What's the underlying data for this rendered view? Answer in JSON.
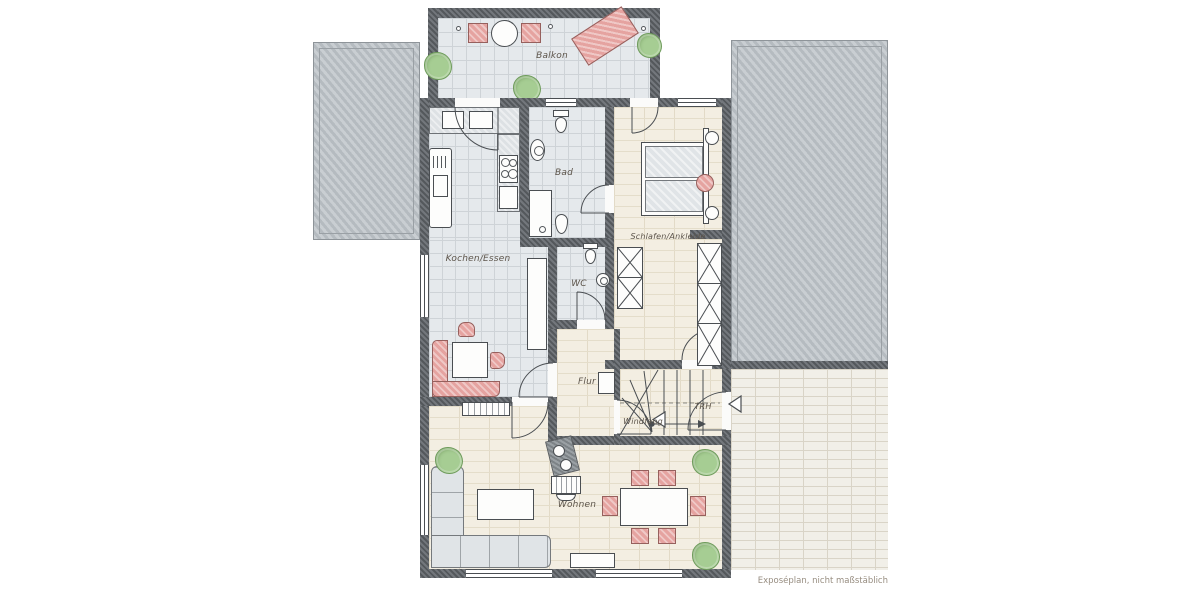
{
  "plan_type": "floor-plan",
  "footer_note": "Exposéplan, nicht maßstäblich",
  "rooms": {
    "balkon": "Balkon",
    "bad": "Bad",
    "kochen_essen": "Kochen/Essen",
    "schlafen_ankleide": "Schlafen/Ankleide",
    "wc": "WC",
    "flur": "Flur",
    "windfang": "Windfang",
    "trh": "TRH",
    "wohnen": "Wohnen"
  },
  "colors": {
    "wall": "#54585c",
    "tile_floor": "#e5e9ec",
    "wood_floor": "#f3eee2",
    "terrace_brick": "#f1efe8",
    "roof_gray": "#c9ced2",
    "furniture_red": "#e5a3a0",
    "furniture_gray": "#e0e4e7",
    "plant_green": "#a6cd93"
  }
}
